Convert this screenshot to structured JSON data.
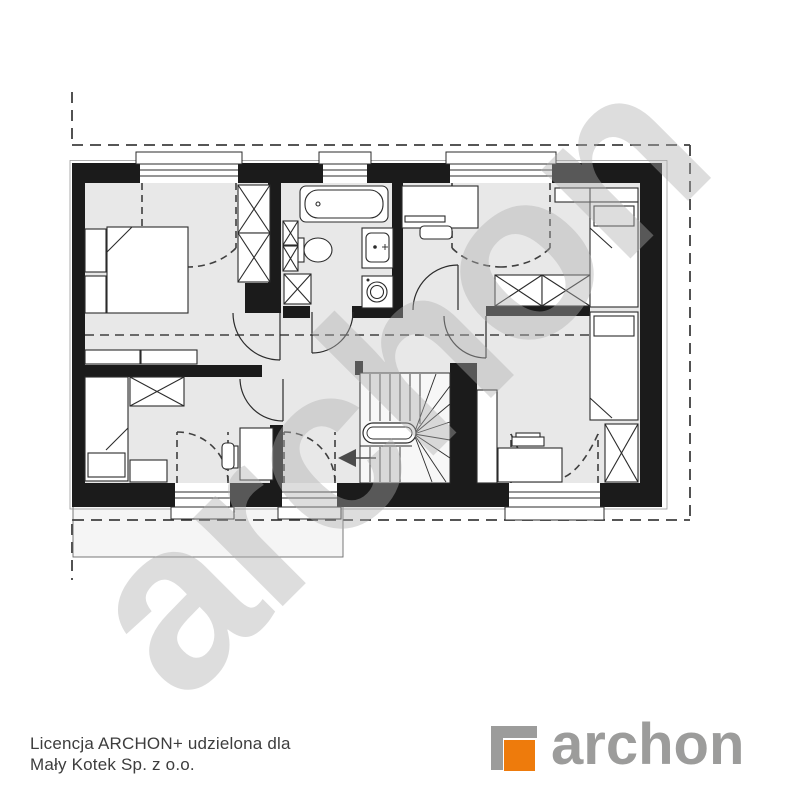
{
  "watermark": {
    "text": "archon"
  },
  "license": {
    "line1": "Licencja ARCHON+ udzielona dla",
    "line2": "Mały Kotek Sp. z o.o."
  },
  "logo": {
    "text": "archon",
    "orange": "#ee7b0c",
    "gray": "#9c9c9b"
  },
  "plan": {
    "kind": "attic-floor-plan",
    "wall_color": "#1b1b1b",
    "floor_color": "#e8e8e8",
    "symbols": [
      "roof-outline-dashed",
      "knee-wall-dashed-line",
      "double-bed",
      "single-bed",
      "wardrobe-crossed",
      "dresser",
      "shelf",
      "desk",
      "chair",
      "bathtub",
      "toilet",
      "washbasin",
      "washing-machine",
      "winder-staircase",
      "stair-direction-arrow",
      "window-casement-dashed-swing",
      "door-swing",
      "lower-roof-projection"
    ]
  }
}
